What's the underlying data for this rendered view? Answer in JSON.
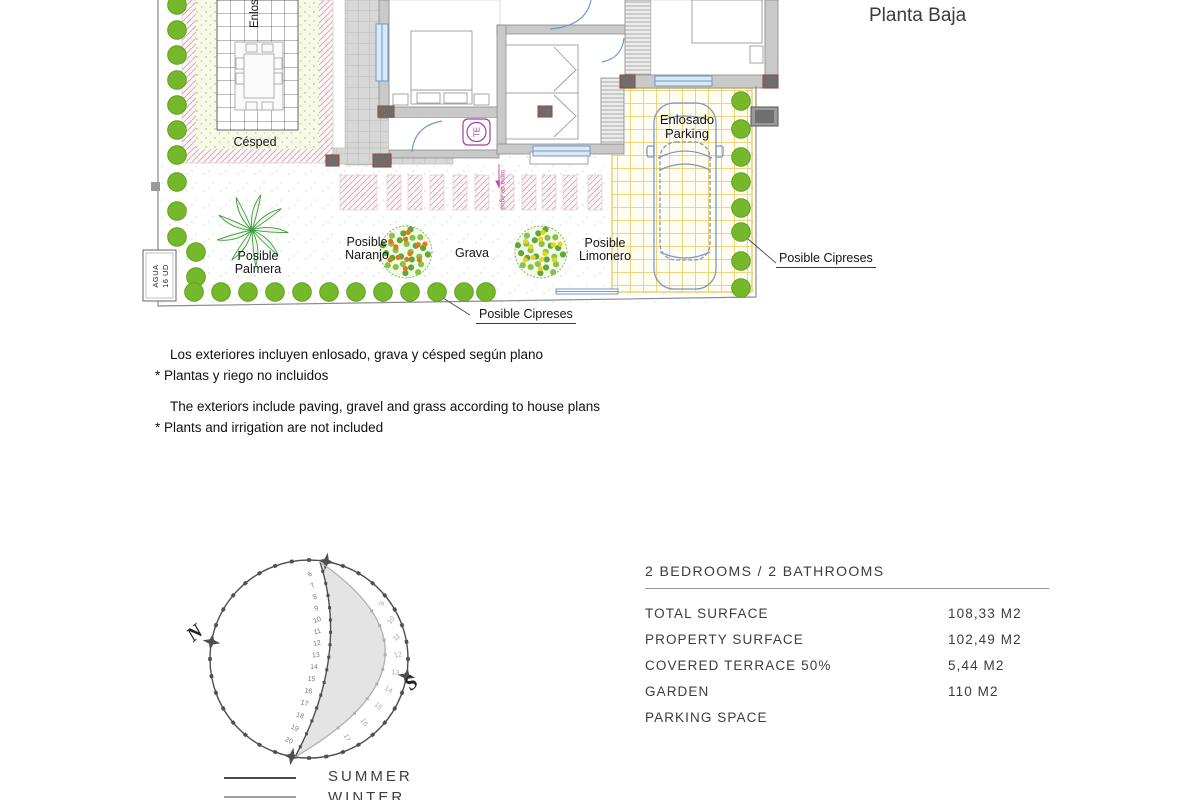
{
  "header": {
    "partial_line": "Nº 24",
    "title": "Planta Baja"
  },
  "plan": {
    "enlosado_vertical": "Enlosado",
    "cesped": "Césped",
    "agua_line1": "AGUA",
    "agua_line2": "16 UD",
    "palmera": "Posible Palmera",
    "naranjo": "Posible Naranjo",
    "grava": "Grava",
    "limonero": "Posible Limonero",
    "parking": "Enlosado Parking",
    "cipreses_bottom": "Posible Cipreses",
    "cipreses_right": "Posible Cipreses",
    "toma_agua": "toma de agua",
    "te_symbol": "TE"
  },
  "notes": {
    "es_line1": "Los exteriores incluyen enlosado, grava y césped según plano",
    "es_line2": "* Plantas y riego no incluidos",
    "en_line1": "The exteriors include paving, gravel and grass according to house plans",
    "en_line2": "* Plants and irrigation are not included"
  },
  "sun_diagram": {
    "north_label": "N",
    "south_label": "S",
    "summer_hours": [
      6,
      7,
      8,
      9,
      10,
      11,
      12,
      13,
      14,
      15,
      16,
      17,
      18,
      19,
      20
    ],
    "winter_hours": [
      9,
      10,
      11,
      12,
      13,
      14,
      15,
      16,
      17
    ],
    "legend": {
      "summer": "SUMMER",
      "winter": "WINTER"
    }
  },
  "summary": {
    "header": "2 BEDROOMS / 2 BATHROOMS",
    "rows": [
      {
        "label": "TOTAL SURFACE",
        "value": "108,33 M2"
      },
      {
        "label": "PROPERTY SURFACE",
        "value": "102,49 M2"
      },
      {
        "label": "COVERED TERRACE 50%",
        "value": "5,44 M2"
      },
      {
        "label": "GARDEN",
        "value": "110 M2"
      },
      {
        "label": "PARKING SPACE",
        "value": ""
      }
    ]
  },
  "colors": {
    "tree_green": "#76b82c",
    "plan_blue": "#7b96c8",
    "parking_yellow": "#ecd06e",
    "hatch_pink": "#dda6b0",
    "magenta": "#a23fa2",
    "sun_dark": "#4f4f4f",
    "sun_light": "#b0b0b0",
    "crescent": "#e4e4e4"
  }
}
